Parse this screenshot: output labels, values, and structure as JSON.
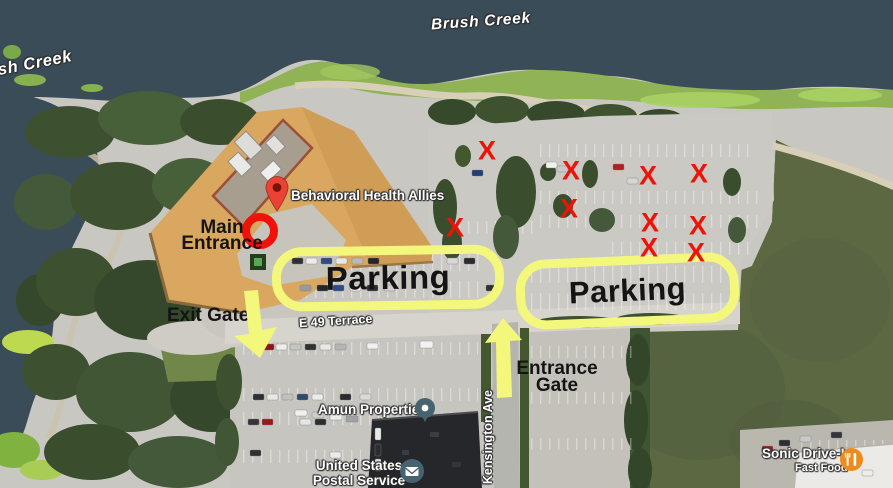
{
  "map_labels": {
    "brush_creek_top": "Brush Creek",
    "brush_creek_left": "Brush Creek",
    "behavioral_health_allies": "Behavioral Health Allies",
    "e49_terrace": "E 49 Terrace",
    "kensington_ave": "Kensington Ave",
    "amun_properties": "Amun Properties",
    "usps_line1": "United States",
    "usps_line2": "Postal Service",
    "sonic_name": "Sonic Drive-In",
    "sonic_category": "Fast Food"
  },
  "annotations": {
    "main_entrance_line1": "Main",
    "main_entrance_line2": "Entrance",
    "exit_gate": "Exit Gate",
    "entrance_gate_line1": "Entrance",
    "entrance_gate_line2": "Gate",
    "parking_left": "Parking",
    "parking_right": "Parking",
    "x_glyph": "X",
    "x_marks": [
      {
        "x": 487,
        "y": 151
      },
      {
        "x": 571,
        "y": 171
      },
      {
        "x": 648,
        "y": 176
      },
      {
        "x": 699,
        "y": 174
      },
      {
        "x": 569,
        "y": 209
      },
      {
        "x": 455,
        "y": 228
      },
      {
        "x": 650,
        "y": 223
      },
      {
        "x": 698,
        "y": 226
      },
      {
        "x": 649,
        "y": 248
      },
      {
        "x": 696,
        "y": 253
      }
    ],
    "colors": {
      "highlight_yellow": "#f3f77c",
      "x_red": "#ec1408",
      "ring_red": "#f01208",
      "pin_red": "#ea4335",
      "annotation_text": "#141414"
    }
  },
  "icons": {
    "pin": "place-pin-icon",
    "amun": "poi-dot-icon",
    "usps": "envelope-icon",
    "sonic": "restaurant-icon"
  }
}
